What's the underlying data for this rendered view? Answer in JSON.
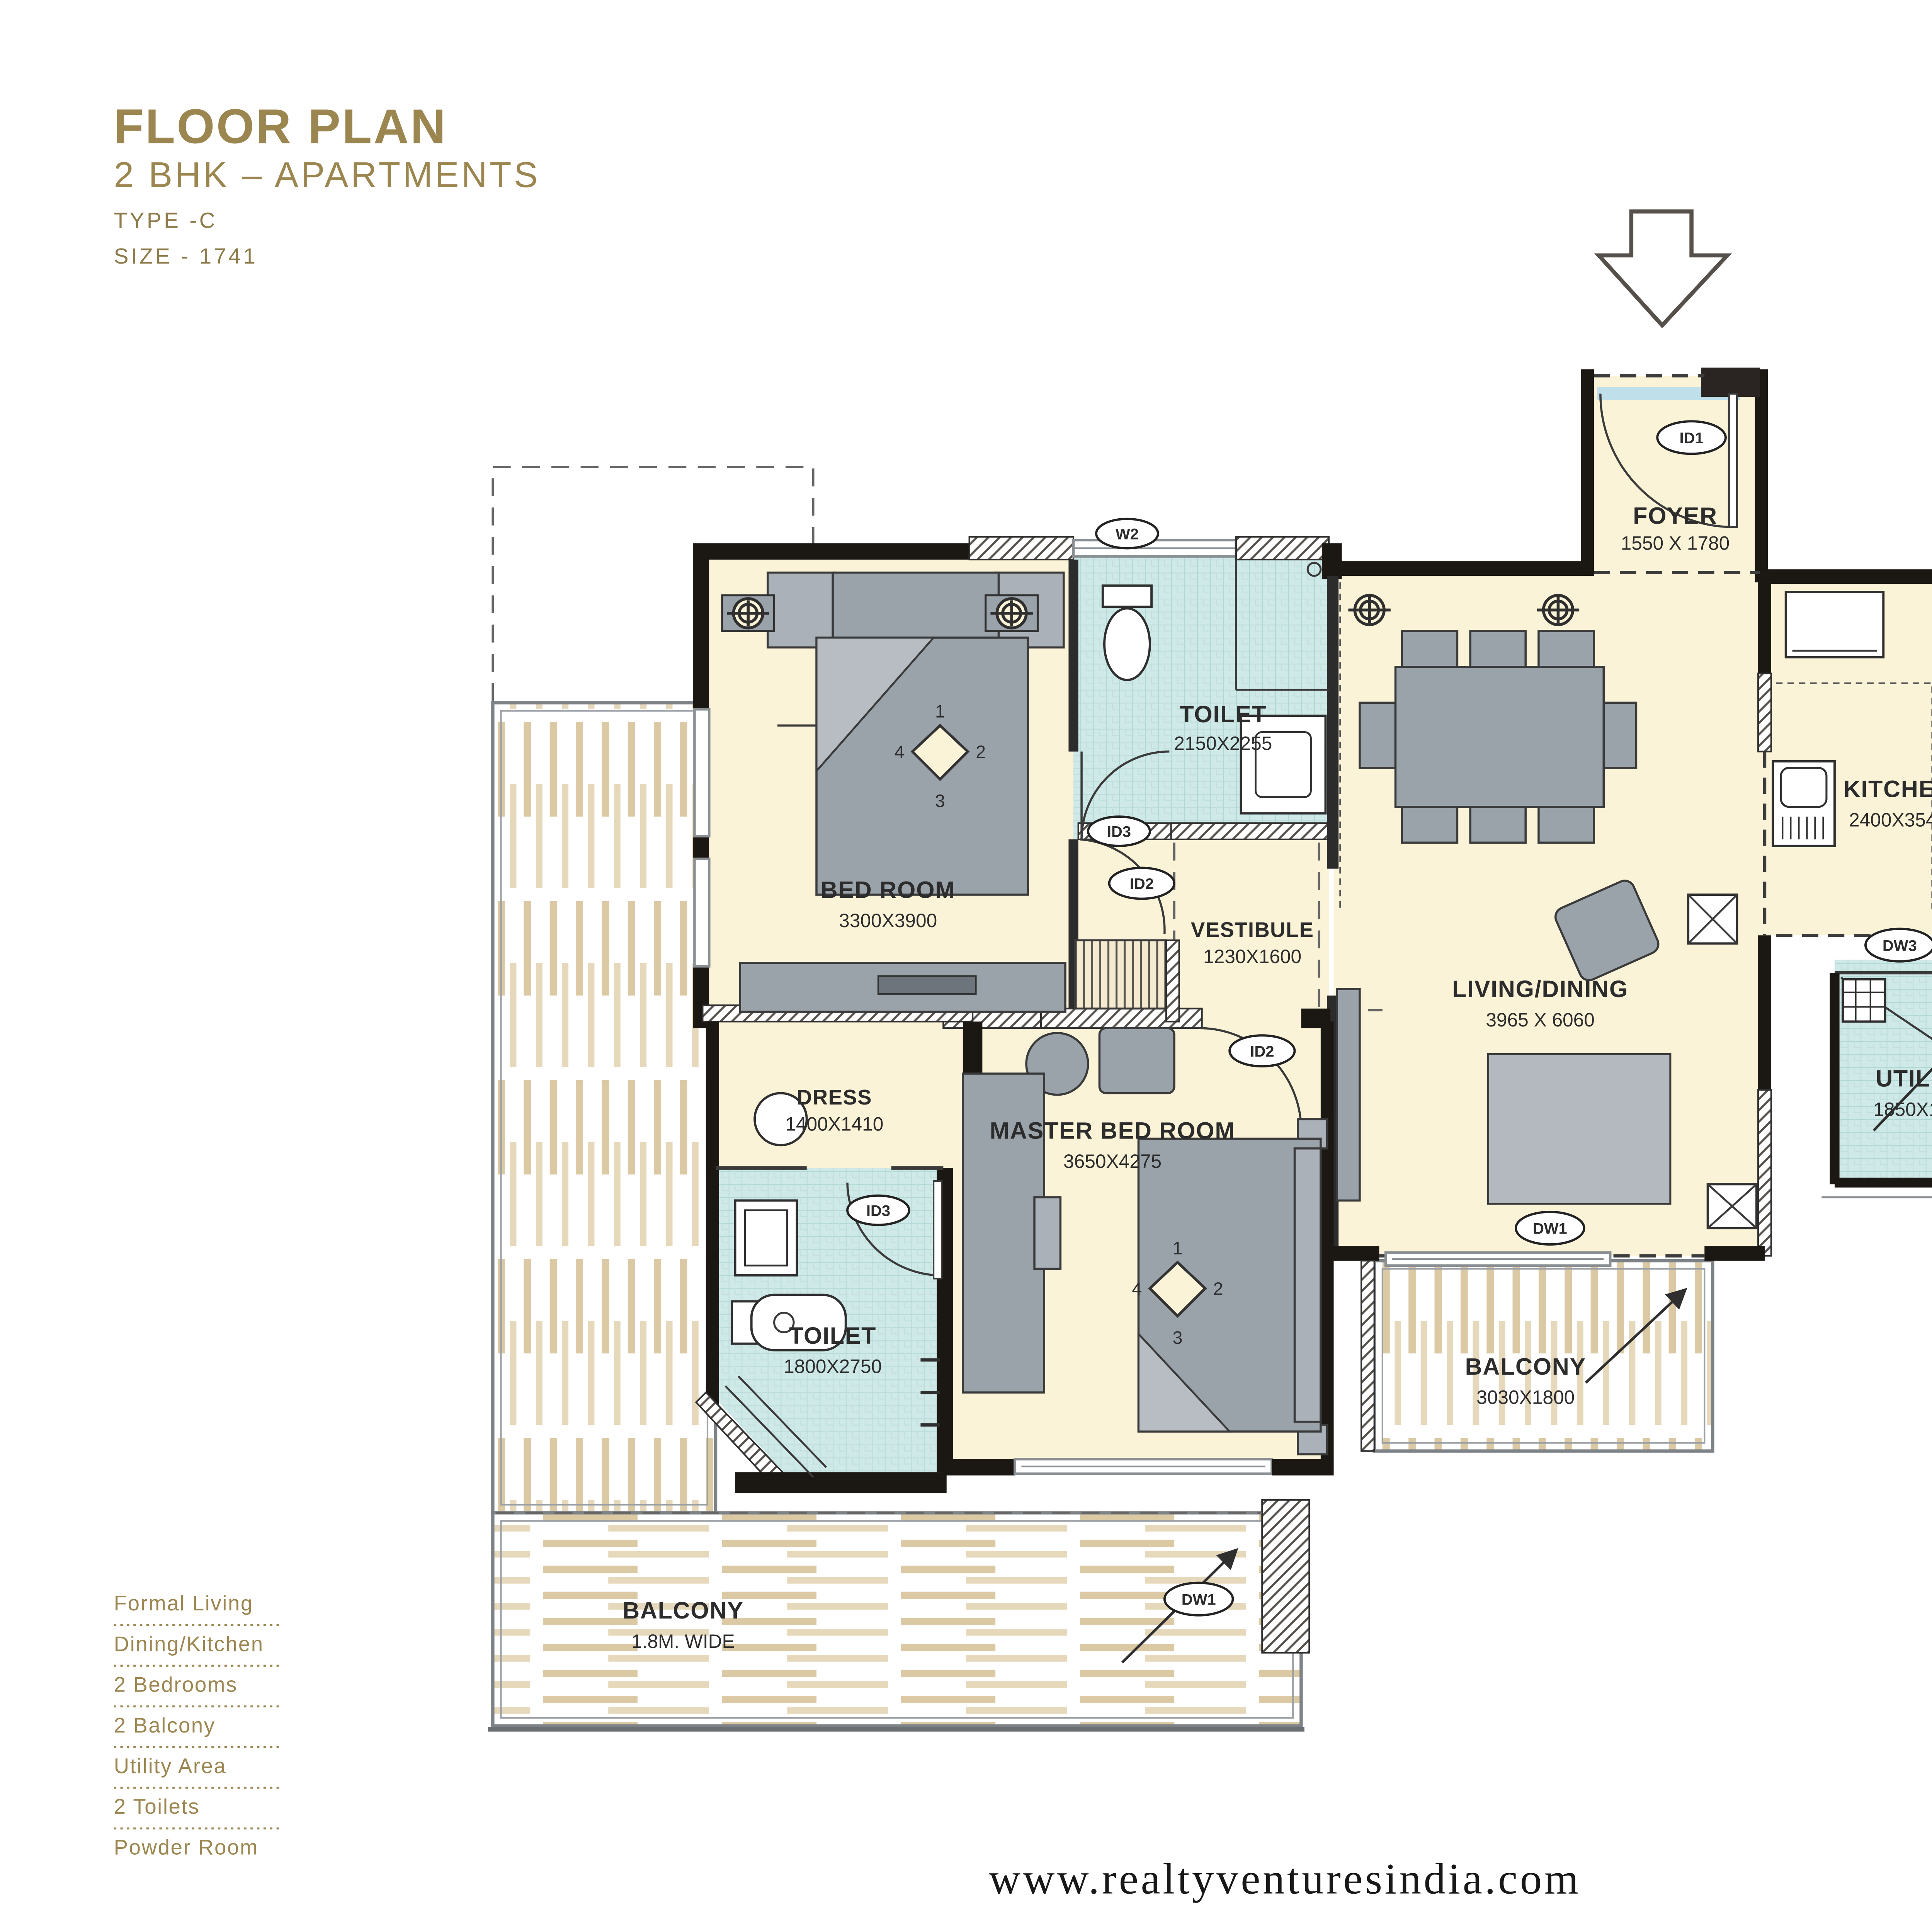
{
  "header": {
    "title": "FLOOR PLAN",
    "subtitle": "2 BHK – APARTMENTS",
    "type_label": "TYPE -C",
    "size_label": "SIZE - 1741"
  },
  "brand": {
    "the": "THE",
    "name": "LEAF",
    "tagline": "At SS City"
  },
  "features": {
    "items": [
      "Formal Living",
      "Dining/Kitchen",
      "2 Bedrooms",
      "2 Balcony",
      "Utility Area",
      "2 Toilets",
      "Powder Room"
    ]
  },
  "rooms": {
    "foyer": {
      "name": "FOYER",
      "dim": "1550 X 1780"
    },
    "bedroom": {
      "name": "BED ROOM",
      "dim": "3300X3900"
    },
    "toilet1": {
      "name": "TOILET",
      "dim": "2150X2255"
    },
    "vestibule": {
      "name": "VESTIBULE",
      "dim": "1230X1600"
    },
    "living": {
      "name": "LIVING/DINING",
      "dim": "3965 X 6060"
    },
    "kitchen": {
      "name": "KITCHEN",
      "dim": "2400X3540"
    },
    "utility": {
      "name": "UTILITY",
      "dim": "1850X1800"
    },
    "dress": {
      "name": "DRESS",
      "dim": "1400X1410"
    },
    "toilet2": {
      "name": "TOILET",
      "dim": "1800X2750"
    },
    "master": {
      "name": "MASTER BED ROOM",
      "dim": "3650X4275"
    },
    "balcony_side": {
      "name": "BALCONY",
      "dim": "3030X1800"
    },
    "balcony_bottom": {
      "name": "BALCONY",
      "dim": "1.8M. WIDE"
    }
  },
  "labels": {
    "id1": "ID1",
    "id2": "ID2",
    "id3": "ID3",
    "w2": "W2",
    "dw1": "DW1",
    "dw3": "DW3"
  },
  "fan_marks": {
    "n1": "1",
    "n2": "2",
    "n3": "3",
    "n4": "4"
  },
  "appliances": {
    "washer_mark": "W"
  },
  "footer": {
    "website": "www.realtyventuresindia.com"
  },
  "colors": {
    "accent_gold": "#9c8650",
    "room_cream": "#fbf3d8",
    "wet_blue": "#cfe9e8",
    "wall_dark": "#1b1713",
    "wood_tan": "#dbc9a4",
    "brand_red": "#e02327",
    "brand_black": "#231f20"
  }
}
